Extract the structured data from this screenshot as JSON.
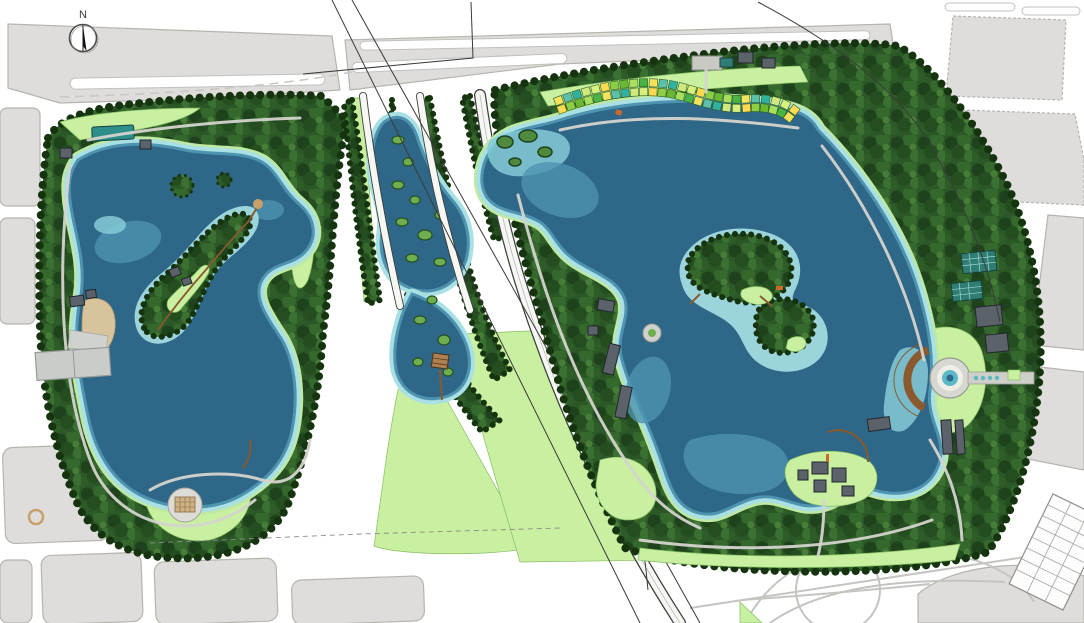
{
  "map": {
    "title": "lakeside-park-masterplan",
    "north_label": "N",
    "features": {
      "west_lake": "west-lake",
      "east_lake": "east-lake",
      "wetland": "central-wetland",
      "flower_terrace": "flower-terrace-beds",
      "east_plaza": "circular-waterfront-plaza",
      "south_plaza": "south-circular-plaza",
      "interchange": "highway-interchange",
      "pier": "west-entry-pier",
      "islands": "lake-islands"
    }
  },
  "palette": {
    "block": "#dedddb",
    "block_stroke": "#b7b4ae",
    "tree_base": "#2c5828",
    "tree_dark": "#16330f",
    "tree_mid": "#3c7233",
    "lawn": "#c9efa0",
    "deep_water": "#2e6787",
    "mid_water": "#4e94b0",
    "shallow": "#85cbd8",
    "shore": "#a9e0e4",
    "sand": "#d8c49c",
    "brown": "#8a5a2e"
  },
  "flower_terrace": {
    "colors": [
      "#f2e25c",
      "#cfe97e",
      "#8ccf45",
      "#49b344",
      "#2fb3a0",
      "#ffd94f",
      "#a6e05c",
      "#5cc0ae",
      "#d8f07e",
      "#6ab832"
    ]
  }
}
